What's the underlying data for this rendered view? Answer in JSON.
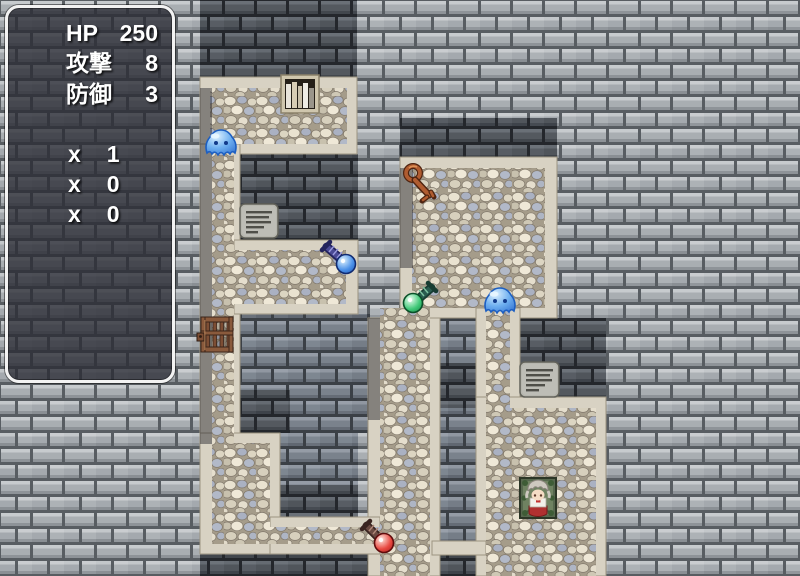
{
  "hud": {
    "stats": [
      {
        "label": "HP",
        "value": "250"
      },
      {
        "label": "攻撃",
        "value": "8"
      },
      {
        "label": "防御",
        "value": "3"
      }
    ],
    "items": [
      {
        "label": "x",
        "value": "1"
      },
      {
        "label": "x",
        "value": "0"
      },
      {
        "label": "x",
        "value": "0"
      }
    ]
  },
  "map": {
    "entities": [
      "blue-slime",
      "blue-slime",
      "orange-key",
      "blue-key",
      "green-key",
      "red-key",
      "jail-gate",
      "bookshelf",
      "stone-sign",
      "stone-sign",
      "character-on-goal-tile"
    ]
  },
  "colors": {
    "hud_border": "#f2f2f2",
    "hud_bg": "rgba(42,44,52,0.78)",
    "slime": "#4a90e8",
    "key_orange": "#b05c30",
    "key_blue": "#2e6ad4",
    "key_green": "#2ec46a",
    "key_red": "#d43030"
  }
}
